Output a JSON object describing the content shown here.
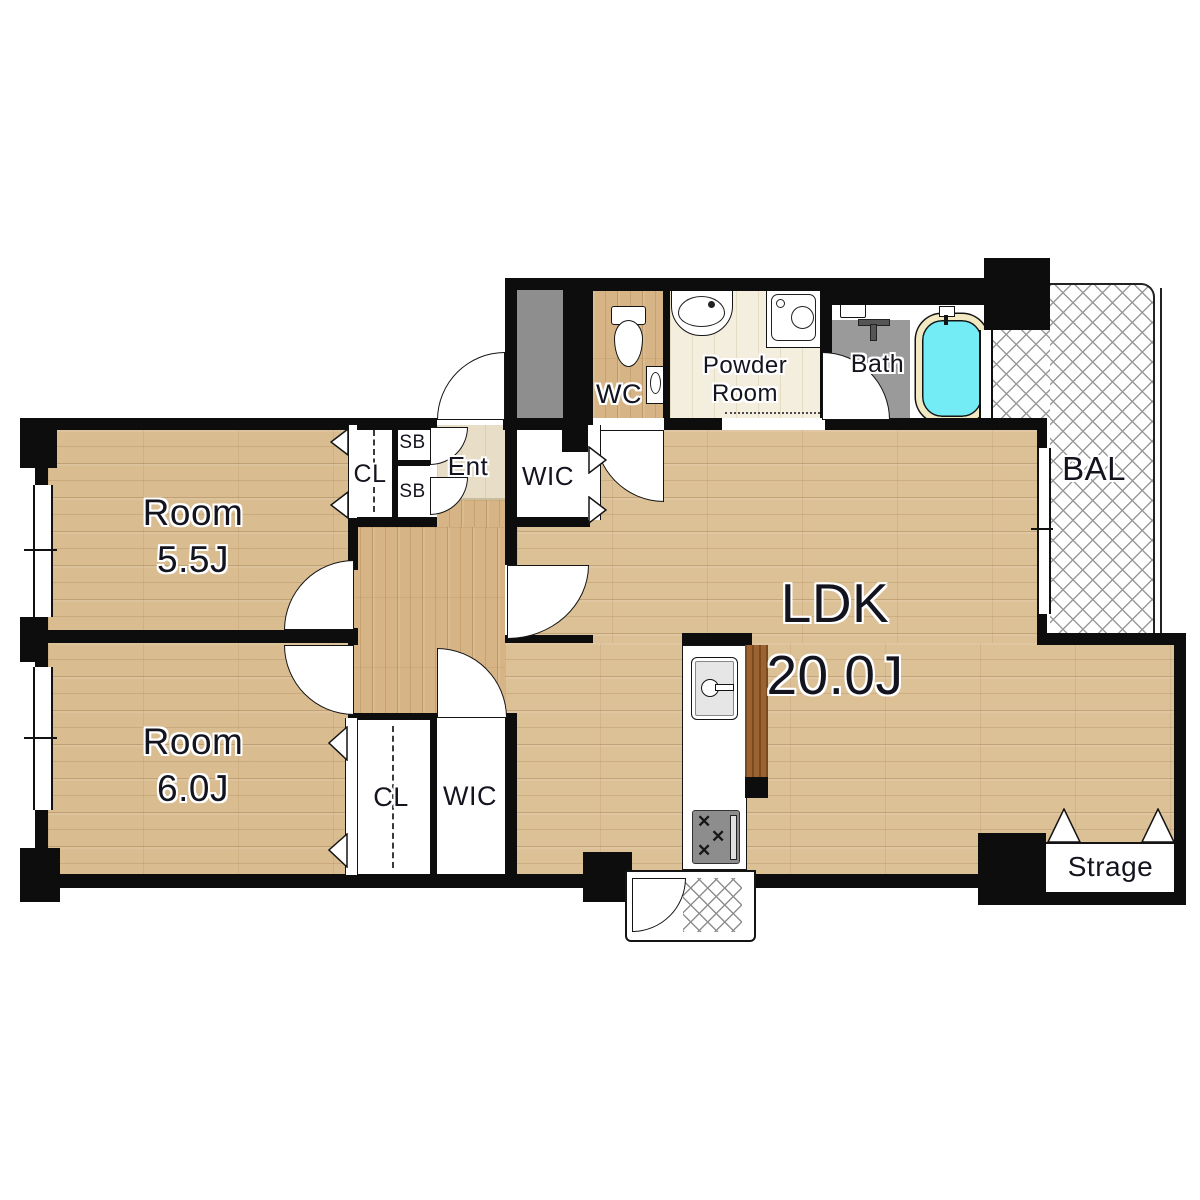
{
  "rooms": {
    "room_55": {
      "line1": "Room",
      "line2": "5.5J"
    },
    "room_60": {
      "line1": "Room",
      "line2": "6.0J"
    },
    "ldk": {
      "line1": "LDK",
      "line2": "20.0J"
    },
    "balcony": {
      "label": "BAL"
    },
    "wc": {
      "label": "WC"
    },
    "powder": {
      "line1": "Powder",
      "line2": "Room"
    },
    "bath": {
      "label": "Bath"
    },
    "entrance": {
      "label": "Ent"
    },
    "wic_upper": {
      "label": "WIC"
    },
    "wic_lower": {
      "label": "WIC"
    },
    "closet_upper": {
      "label": "CL"
    },
    "closet_lower": {
      "label": "CL"
    },
    "shoebox_upper": {
      "label": "SB"
    },
    "shoebox_lower": {
      "label": "SB"
    },
    "storage": {
      "label": "Strage"
    }
  },
  "colors": {
    "wall": "#0d0d0d",
    "wood_floor": "#d9bc90",
    "hall_wood": "#d6b485",
    "entrance_tile": "#e8dec7",
    "powder_floor": "#f4eede",
    "bath_floor": "#9a9a9a",
    "duct_shaft": "#8e8e8e",
    "tub_water": "#74ecf6",
    "tub_rim": "#f2e8c2",
    "kitchen_counter_edge": "#9c622f",
    "label_text": "#14141f",
    "hatch_line": "#9a9a9a"
  }
}
